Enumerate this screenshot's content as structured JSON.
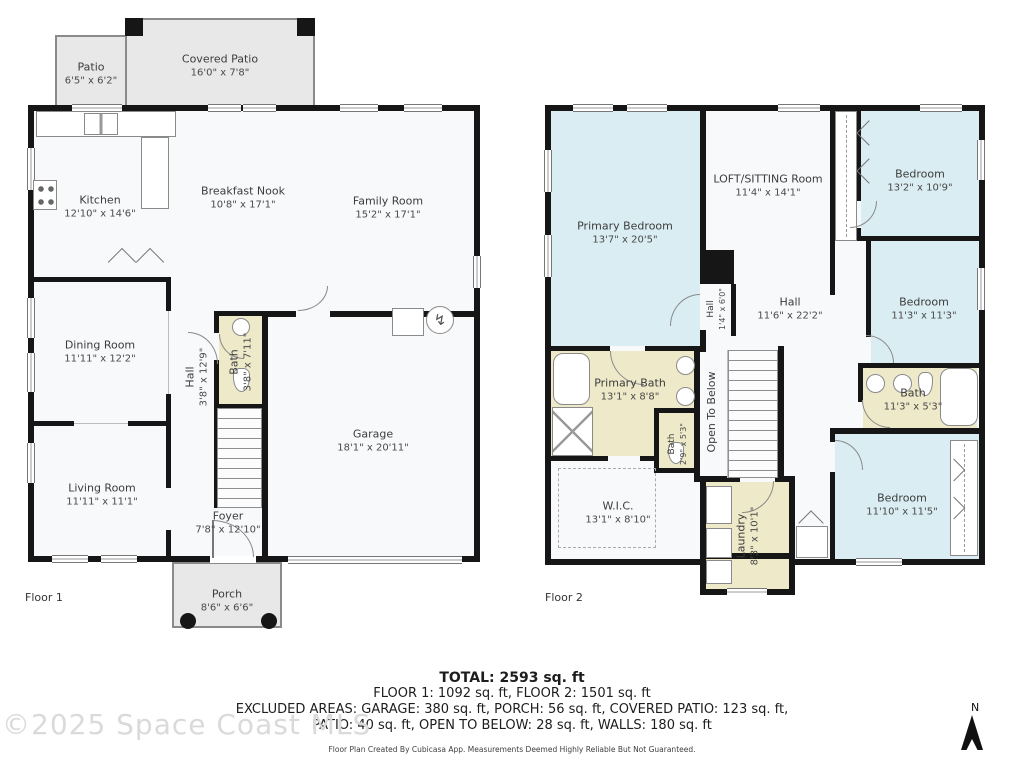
{
  "floor1": {
    "label": "Floor 1",
    "rooms": {
      "patio": {
        "name": "Patio",
        "dims": "6'5\" x 6'2\""
      },
      "covered_patio": {
        "name": "Covered Patio",
        "dims": "16'0\" x 7'8\""
      },
      "kitchen": {
        "name": "Kitchen",
        "dims": "12'10\" x 14'6\""
      },
      "breakfast_nook": {
        "name": "Breakfast Nook",
        "dims": "10'8\" x 17'1\""
      },
      "family_room": {
        "name": "Family Room",
        "dims": "15'2\" x 17'1\""
      },
      "dining_room": {
        "name": "Dining Room",
        "dims": "11'11\" x 12'2\""
      },
      "hall": {
        "name": "Hall",
        "dims": "3'8\" x 12'9\""
      },
      "bath": {
        "name": "Bath",
        "dims": "3'8\" x 7'11\""
      },
      "living_room": {
        "name": "Living Room",
        "dims": "11'11\" x 11'1\""
      },
      "foyer": {
        "name": "Foyer",
        "dims": "7'8\" x 12'10\""
      },
      "garage": {
        "name": "Garage",
        "dims": "18'1\" x 20'11\""
      },
      "porch": {
        "name": "Porch",
        "dims": "8'6\" x 6'6\""
      }
    }
  },
  "floor2": {
    "label": "Floor 2",
    "rooms": {
      "primary_bedroom": {
        "name": "Primary Bedroom",
        "dims": "13'7\" x 20'5\""
      },
      "loft": {
        "name": "LOFT/SITTING Room",
        "dims": "11'4\" x 14'1\""
      },
      "bedroom_tr": {
        "name": "Bedroom",
        "dims": "13'2\" x 10'9\""
      },
      "bedroom_mr": {
        "name": "Bedroom",
        "dims": "11'3\" x 11'3\""
      },
      "hall": {
        "name": "Hall",
        "dims": "11'6\" x 22'2\""
      },
      "hall_small": {
        "name": "Hall",
        "dims": "1'4\" x 6'0\""
      },
      "primary_bath": {
        "name": "Primary Bath",
        "dims": "13'1\" x 8'8\""
      },
      "bath_small": {
        "name": "Bath",
        "dims": "2'9\" x 5'3\""
      },
      "open_to_below": {
        "name": "Open To Below"
      },
      "wic": {
        "name": "W.I.C.",
        "dims": "13'1\" x 8'10\""
      },
      "laundry": {
        "name": "Laundry",
        "dims": "8'3\" x 10'1\""
      },
      "bath": {
        "name": "Bath",
        "dims": "11'3\" x 5'3\""
      },
      "bedroom_br": {
        "name": "Bedroom",
        "dims": "11'10\" x 11'5\""
      }
    }
  },
  "summary": {
    "total": "TOTAL: 2593 sq. ft",
    "floors": "FLOOR 1: 1092 sq. ft, FLOOR 2: 1501 sq. ft",
    "excluded1": "EXCLUDED AREAS: GARAGE: 380 sq. ft, PORCH: 56 sq. ft, COVERED PATIO: 123 sq. ft,",
    "excluded2": "PATIO: 40 sq. ft, OPEN TO BELOW: 28 sq. ft, WALLS: 180 sq. ft",
    "disclaimer": "Floor Plan Created By Cubicasa App. Measurements Deemed Highly Reliable But Not Guaranteed."
  },
  "watermark": "©2025 Space Coast MLS",
  "compass": {
    "label": "N"
  },
  "colors": {
    "wall": "#161616",
    "bedroom_fill": "#d9edf2",
    "bath_fill": "#ede9c9",
    "outdoor_fill": "#e8e8e8",
    "floor_fill": "#f7f9fb"
  }
}
